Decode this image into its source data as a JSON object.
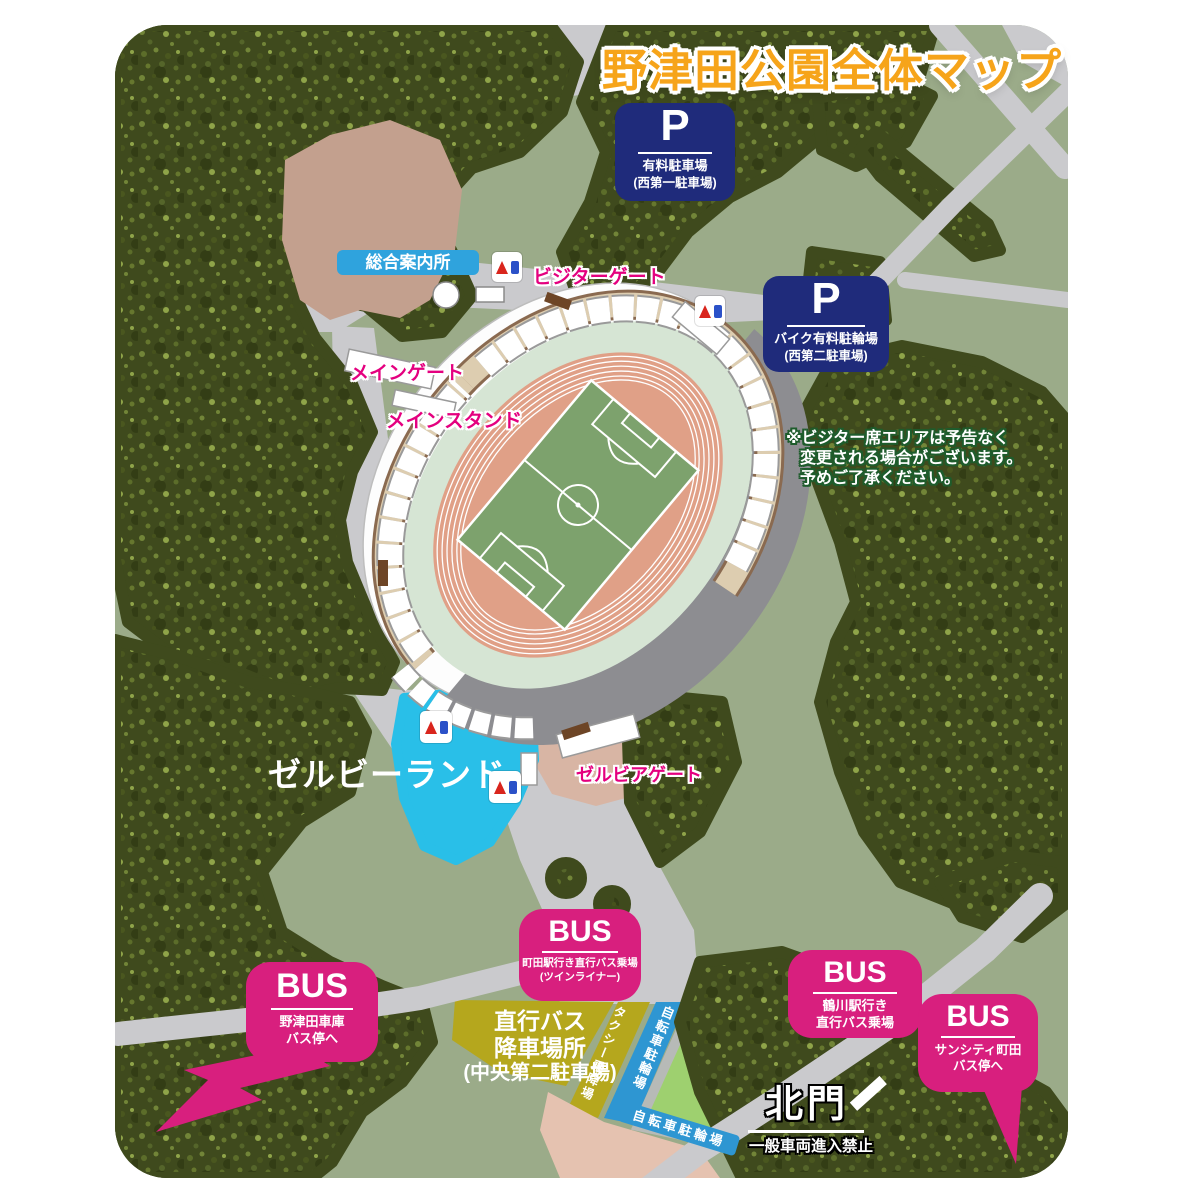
{
  "title": "野津田公園全体マップ",
  "colors": {
    "map_background": "#9bab89",
    "tree_green": "#3f4a1d",
    "road_gray": "#cacacd",
    "parking_navy": "#1f2b7b",
    "bus_magenta": "#d81f7e",
    "gate_pink": "#e4007f",
    "title_orange": "#f6a41a",
    "info_blue": "#2fa3dd",
    "zelvie_cyan": "#29bfe8",
    "track_salmon": "#e0a087",
    "pitch_green": "#7da26d",
    "stand_gray": "#8d8d91",
    "taxi_olive": "#b5a71d",
    "bicycle_blue": "#2e96d2",
    "lot_green": "#9ed06f"
  },
  "signs": {
    "parking": [
      {
        "symbol": "P",
        "line1": "有料駐車場",
        "line2": "(西第一駐車場)"
      },
      {
        "symbol": "P",
        "line1": "バイク有料駐輪場",
        "line2": "(西第二駐車場)"
      }
    ],
    "bus": [
      {
        "symbol": "BUS",
        "line1": "町田駅行き直行バス乗場",
        "line2": "(ツインライナー)"
      },
      {
        "symbol": "BUS",
        "line1": "野津田車庫",
        "line2": "バス停へ"
      },
      {
        "symbol": "BUS",
        "line1": "鶴川駅行き",
        "line2": "直行バス乗場"
      },
      {
        "symbol": "BUS",
        "line1": "サンシティ町田",
        "line2": "バス停へ"
      }
    ]
  },
  "labels": {
    "info_center": "総合案内所",
    "visitor_gate": "ビジターゲート",
    "main_gate": "メインゲート",
    "main_stand": "メインスタンド",
    "zelvie_land": "ゼルビーランド",
    "zelvia_gate": "ゼルビアゲート",
    "north_gate": "北門",
    "north_gate_note": "一般車両進入禁止",
    "bus_drop_1": "直行バス",
    "bus_drop_2": "降車場所",
    "bus_drop_3": "(中央第二駐車場)",
    "taxi": "タクシー乗降場",
    "bicycle_1": "自転車駐輪場",
    "bicycle_2": "自転車駐輪場"
  },
  "notice": {
    "line1": "※ビジター席エリアは予告なく",
    "line2": "変更される場合がございます。",
    "line3": "予めご了承ください。"
  }
}
